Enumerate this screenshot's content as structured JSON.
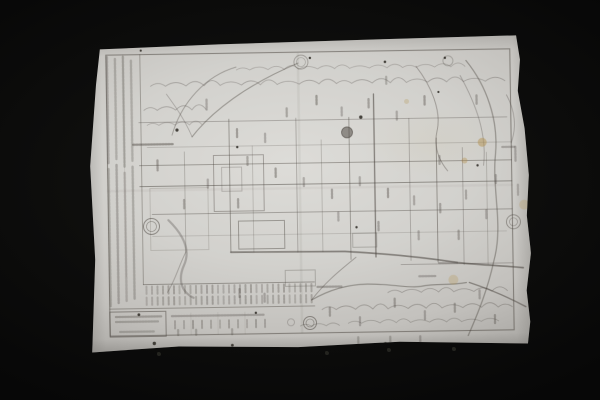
{
  "scene": {
    "description": "Photograph of an antique Japanese woodblock-printed map (faint ink on aged paper) lying on a black background",
    "background_color": "#0d0d0c",
    "paper_base_color": "#d2d1cd",
    "paper_edge_color": "#a9a7a3",
    "ink_color": "#46403a",
    "stain_color": "#b3924f",
    "legible_text": "none - all printed text is too faint/small to read"
  },
  "print": {
    "frame": {
      "x": 20,
      "y": 14,
      "w": 404,
      "h": 281,
      "o": 0.5,
      "w2": 1.1
    },
    "legend_rules": [
      [
        54,
        14,
        244,
        0.4
      ],
      [
        37,
        14,
        236,
        0.12
      ]
    ],
    "legend_columns": [
      [
        21,
        16,
        122,
        0.3
      ],
      [
        21,
        128,
        265,
        0.28
      ],
      [
        29,
        18,
        118,
        0.26
      ],
      [
        29,
        124,
        262,
        0.3
      ],
      [
        37,
        16,
        126,
        0.28
      ],
      [
        37,
        132,
        260,
        0.24
      ],
      [
        45,
        20,
        120,
        0.26
      ],
      [
        45,
        126,
        258,
        0.28
      ]
    ],
    "grid_h": [
      [
        82,
        52,
        420,
        0.3,
        0.9
      ],
      [
        107,
        60,
        424,
        0.26,
        0.8
      ],
      [
        125,
        52,
        424,
        0.4,
        1
      ],
      [
        146,
        52,
        424,
        0.48,
        1.1
      ],
      [
        174,
        64,
        424,
        0.36,
        0.9
      ],
      [
        196,
        64,
        418,
        0.22,
        0.8
      ],
      [
        228,
        312,
        424,
        0.3,
        0.9
      ],
      [
        244,
        54,
        225,
        0.42,
        0.9
      ],
      [
        268,
        20,
        225,
        0.4,
        0.9
      ]
    ],
    "grid_v": [
      [
        97,
        112,
        212,
        0.28,
        0.9
      ],
      [
        142,
        80,
        213,
        0.42,
        1
      ],
      [
        165,
        107,
        213,
        0.26,
        0.8
      ],
      [
        209,
        80,
        214,
        0.34,
        0.9
      ],
      [
        234,
        102,
        214,
        0.28,
        0.8
      ],
      [
        262,
        80,
        222,
        0.4,
        1
      ],
      [
        287,
        57,
        220,
        0.58,
        1.3
      ],
      [
        322,
        82,
        224,
        0.32,
        0.9
      ],
      [
        349,
        102,
        226,
        0.44,
        1
      ],
      [
        375,
        112,
        229,
        0.32,
        0.9
      ],
      [
        399,
        117,
        229,
        0.28,
        0.8
      ],
      [
        101,
        273,
        295,
        0.12,
        0.8
      ],
      [
        128,
        273,
        295,
        0.12,
        0.8
      ],
      [
        155,
        273,
        295,
        0.12,
        0.8
      ]
    ],
    "blocks": [
      [
        126,
        116,
        50,
        56,
        0.38
      ],
      [
        134,
        128,
        20,
        24,
        0.25
      ],
      [
        150,
        182,
        46,
        28,
        0.42
      ],
      [
        62,
        148,
        58,
        62,
        0.18
      ],
      [
        196,
        232,
        30,
        16,
        0.28
      ],
      [
        264,
        196,
        24,
        14,
        0.28
      ],
      [
        20,
        271,
        56,
        25,
        0.5
      ]
    ],
    "mountain_chains": [
      {
        "x": 64,
        "y": 46,
        "n": 19,
        "w": 19,
        "h": 8,
        "o": 0.3
      },
      {
        "x": 150,
        "y": 31,
        "n": 14,
        "w": 17,
        "h": 6,
        "o": 0.25
      },
      {
        "x": 57,
        "y": 70,
        "n": 4,
        "w": 17,
        "h": 8,
        "o": 0.3
      },
      {
        "x": 60,
        "y": 85,
        "n": 4,
        "w": 15,
        "h": 6,
        "o": 0.25
      },
      {
        "x": 298,
        "y": 256,
        "n": 7,
        "w": 18,
        "h": 7,
        "o": 0.3
      },
      {
        "x": 232,
        "y": 272,
        "n": 11,
        "w": 18,
        "h": 8,
        "o": 0.32
      },
      {
        "x": 258,
        "y": 286,
        "n": 9,
        "w": 17,
        "h": 6,
        "o": 0.28
      },
      {
        "x": 210,
        "y": 288,
        "n": 3,
        "w": 14,
        "h": 5,
        "o": 0.28
      }
    ],
    "strokes": [
      {
        "d": "M85 95 C95 62 120 36 150 28",
        "o": 0.35,
        "w": 1
      },
      {
        "d": "M105 97 C125 72 160 46 212 25",
        "o": 0.4,
        "w": 1.1
      },
      {
        "d": "M105 97 C98 80 90 68 80 54",
        "o": 0.3,
        "w": 0.9
      },
      {
        "d": "M380 25 C400 50 412 85 408 120 C404 155 415 190 405 225 C398 255 388 278 378 300",
        "o": 0.4,
        "w": 1.3
      },
      {
        "d": "M374 40 C390 70 400 100 396 130",
        "o": 0.3,
        "w": 1
      },
      {
        "d": "M142 213 L256 214 C300 217 340 222 369 227 C395 230 418 231 434 233",
        "o": 0.55,
        "w": 1.7
      },
      {
        "d": "M222 262 C240 252 258 247 278 247 C302 247 318 252 332 250 C348 247 360 250 377 247",
        "o": 0.42,
        "w": 1.2
      },
      {
        "d": "M267 220 C252 232 236 244 222 262",
        "o": 0.38,
        "w": 1
      },
      {
        "d": "M80 180 C95 195 102 210 95 225 C88 240 92 252 104 258",
        "o": 0.3,
        "w": 2.2
      },
      {
        "d": "M97 212 C90 225 86 240 78 252",
        "o": 0.32,
        "w": 1
      },
      {
        "d": "M330 30 C345 50 355 75 350 95 C346 112 352 125 360 135",
        "o": 0.38,
        "w": 1
      },
      {
        "d": "M380 247 C400 254 418 262 436 272",
        "o": 0.5,
        "w": 1.4
      },
      {
        "d": "M420 60 C428 75 430 92 424 108",
        "o": 0.3,
        "w": 1
      }
    ],
    "seals": [
      {
        "x": 215,
        "y": 24,
        "r": 7,
        "r2": 4.5,
        "fill": false,
        "o": 0.35
      },
      {
        "x": 260,
        "y": 95,
        "r": 5.5,
        "r2": 0,
        "fill": true,
        "o": 0.5
      },
      {
        "x": 63,
        "y": 186,
        "r": 8,
        "r2": 5,
        "fill": false,
        "o": 0.5
      },
      {
        "x": 425,
        "y": 187,
        "r": 7,
        "r2": 4,
        "fill": false,
        "o": 0.42
      },
      {
        "x": 220,
        "y": 285,
        "r": 6.5,
        "r2": 4,
        "fill": false,
        "o": 0.5
      },
      {
        "x": 201,
        "y": 284,
        "r": 3.5,
        "r2": 0,
        "fill": false,
        "o": 0.25
      },
      {
        "x": 362,
        "y": 25,
        "r": 5,
        "r2": 0,
        "fill": false,
        "o": 0.28
      }
    ],
    "label_marks_vertical": [
      [
        120,
        60,
        10,
        0.3
      ],
      [
        150,
        90,
        8,
        0.38
      ],
      [
        178,
        95,
        9,
        0.3
      ],
      [
        200,
        70,
        8,
        0.33
      ],
      [
        230,
        58,
        9,
        0.4
      ],
      [
        255,
        70,
        8,
        0.3
      ],
      [
        282,
        62,
        9,
        0.35
      ],
      [
        310,
        75,
        8,
        0.3
      ],
      [
        338,
        60,
        9,
        0.38
      ],
      [
        300,
        40,
        7,
        0.28
      ],
      [
        160,
        118,
        8,
        0.33
      ],
      [
        188,
        130,
        9,
        0.4
      ],
      [
        216,
        140,
        8,
        0.3
      ],
      [
        244,
        152,
        9,
        0.36
      ],
      [
        272,
        140,
        8,
        0.3
      ],
      [
        300,
        152,
        9,
        0.38
      ],
      [
        326,
        160,
        8,
        0.3
      ],
      [
        352,
        168,
        9,
        0.34
      ],
      [
        378,
        155,
        8,
        0.3
      ],
      [
        150,
        160,
        9,
        0.36
      ],
      [
        120,
        140,
        8,
        0.3
      ],
      [
        96,
        160,
        9,
        0.33
      ],
      [
        70,
        120,
        10,
        0.38
      ],
      [
        250,
        175,
        8,
        0.3
      ],
      [
        290,
        185,
        9,
        0.35
      ],
      [
        330,
        195,
        8,
        0.3
      ],
      [
        370,
        195,
        9,
        0.34
      ],
      [
        398,
        175,
        8,
        0.3
      ],
      [
        408,
        140,
        8,
        0.3
      ],
      [
        390,
        60,
        9,
        0.33
      ],
      [
        352,
        120,
        8,
        0.3
      ],
      [
        150,
        250,
        8,
        0.33
      ],
      [
        175,
        255,
        8,
        0.3
      ],
      [
        240,
        270,
        8,
        0.34
      ],
      [
        270,
        280,
        8,
        0.3
      ],
      [
        305,
        262,
        8,
        0.35
      ],
      [
        335,
        275,
        8,
        0.3
      ],
      [
        365,
        268,
        8,
        0.33
      ],
      [
        390,
        255,
        8,
        0.3
      ],
      [
        405,
        280,
        8,
        0.34
      ],
      [
        300,
        300,
        7,
        0.28
      ],
      [
        330,
        300,
        7,
        0.3
      ],
      [
        268,
        300,
        7,
        0.28
      ],
      [
        428,
        112,
        14,
        0.3
      ],
      [
        430,
        150,
        10,
        0.25
      ],
      [
        88,
        290,
        5,
        0.28
      ],
      [
        106,
        290,
        5,
        0.28
      ],
      [
        142,
        290,
        5,
        0.28
      ]
    ],
    "label_marks_horizontal": [
      [
        46,
        104,
        40,
        0.45
      ],
      [
        228,
        249,
        24,
        0.35
      ],
      [
        350,
        227,
        18,
        0.3
      ],
      [
        415,
        112,
        12,
        0.3
      ],
      [
        330,
        240,
        16,
        0.3
      ],
      [
        26,
        276,
        46,
        0.32
      ],
      [
        26,
        281,
        42,
        0.28
      ],
      [
        30,
        291,
        34,
        0.26
      ],
      [
        82,
        276,
        92,
        0.3
      ]
    ],
    "micro_column_bands": [
      {
        "x1": 57,
        "x2": 223,
        "step": 5.5,
        "rows": [
          [
            246,
            254
          ],
          [
            257,
            265
          ]
        ],
        "o": 0.3
      },
      {
        "x1": 85,
        "x2": 175,
        "step": 9,
        "rows": [
          [
            281,
            289
          ]
        ],
        "o": 0.3
      }
    ],
    "stains": [
      [
        395,
        107,
        4.5,
        0.5
      ],
      [
        377,
        125,
        3,
        0.4
      ],
      [
        364,
        244,
        5,
        0.28
      ],
      [
        436,
        170,
        5,
        0.25
      ],
      [
        320,
        65,
        2.5,
        0.28
      ]
    ],
    "specks": [
      [
        90,
        90,
        1.6
      ],
      [
        224,
        20,
        1.2
      ],
      [
        299,
        25,
        1.3
      ],
      [
        359,
        22,
        1.2
      ],
      [
        274,
        80,
        1.7
      ],
      [
        150,
        108,
        1.2
      ],
      [
        49,
        274,
        1.4
      ],
      [
        64,
        303,
        1.7
      ],
      [
        142,
        306,
        1.4
      ],
      [
        295,
        307,
        1.7
      ],
      [
        166,
        274,
        1.2
      ],
      [
        352,
        56,
        1.1
      ],
      [
        390,
        130,
        1.2
      ],
      [
        268,
        190,
        1.2
      ],
      [
        55,
        10,
        1.1
      ]
    ],
    "creases": [
      {
        "dir": "v",
        "pos": 212,
        "a": 16,
        "b": 294,
        "o": 0.07
      },
      {
        "dir": "h",
        "pos": 150,
        "a": 20,
        "b": 424,
        "o": 0.05
      }
    ]
  },
  "background_marks": [
    {
      "x": 157,
      "y": 352
    },
    {
      "x": 325,
      "y": 351
    },
    {
      "x": 387,
      "y": 348
    },
    {
      "x": 452,
      "y": 347
    }
  ]
}
